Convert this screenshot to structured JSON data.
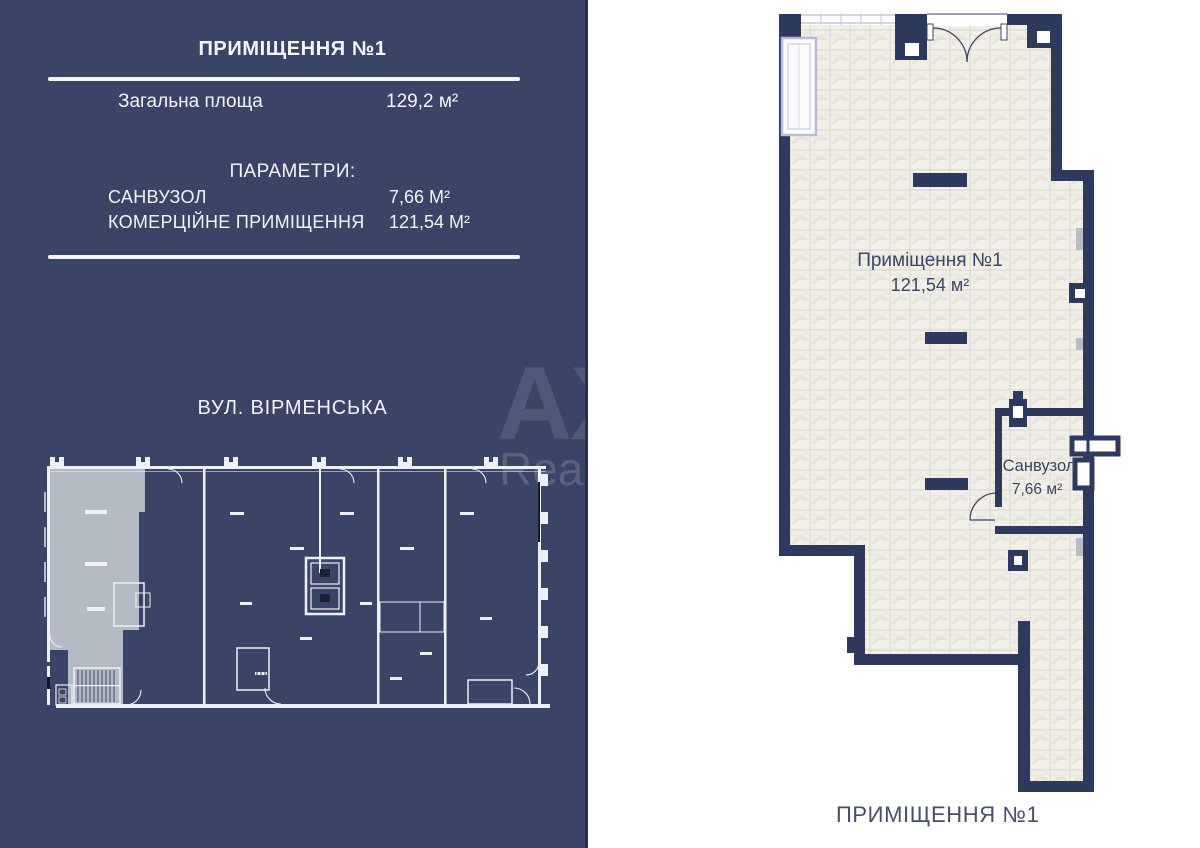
{
  "panel": {
    "title": "ПРИМІЩЕННЯ №1",
    "total_area_label": "Загальна площа",
    "total_area_value": "129,2 м²",
    "parameters_heading": "ПАРАМЕТРИ:",
    "parameters": [
      {
        "label": "САНВУЗОЛ",
        "value": "7,66 М²"
      },
      {
        "label": "КОМЕРЦІЙНЕ ПРИМІЩЕННЯ",
        "value": "121,54 М²"
      }
    ],
    "street_label": "ВУЛ. ВІРМЕНСЬКА",
    "watermark_line1": "AX",
    "watermark_line2": "Real",
    "colors": {
      "panel_bg": "#3a4466",
      "panel_text": "#f3f5f8",
      "unit_highlight": "#b5bbc5",
      "outline_white": "#edf0f4"
    }
  },
  "plan": {
    "room1_label": "Приміщення №1",
    "room1_area": "121,54 м²",
    "bathroom_label": "Санвузол",
    "bathroom_area": "7,66 м²",
    "caption": "ПРИМІЩЕННЯ №1",
    "colors": {
      "wall": "#2e3a5d",
      "tile": "#f1efe8",
      "grout": "#d8d5ca",
      "window_frame": "#b9badb",
      "label_text": "#3a4665"
    }
  }
}
